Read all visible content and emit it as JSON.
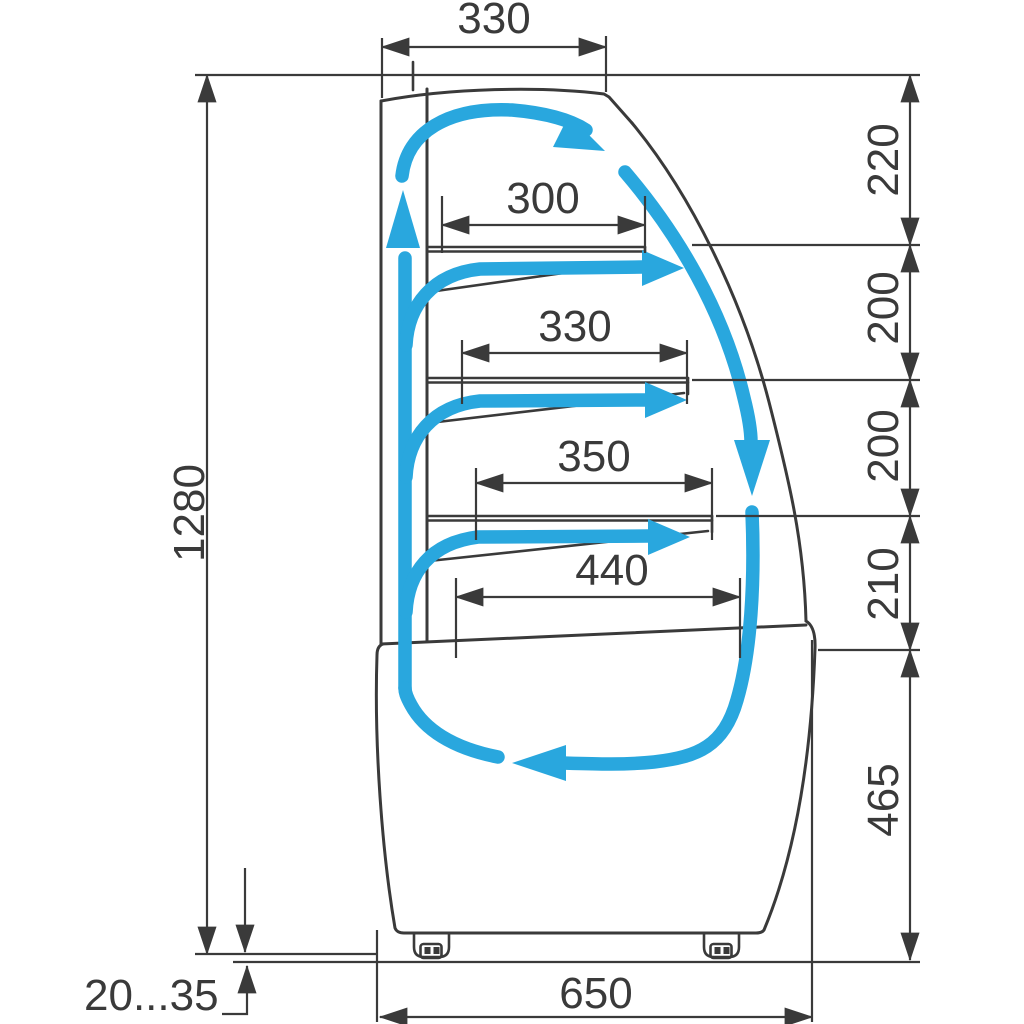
{
  "colors": {
    "accent": "#29a7de",
    "line": "#3a3a3a",
    "bg": "#ffffff"
  },
  "diagram": {
    "top_width": "330",
    "total_height": "1280",
    "shelf_depths": [
      "300",
      "330",
      "350",
      "440"
    ],
    "level_heights": [
      "220",
      "200",
      "200",
      "210"
    ],
    "base_height": "465",
    "base_depth": "650",
    "floor_clearance": "20...35"
  }
}
